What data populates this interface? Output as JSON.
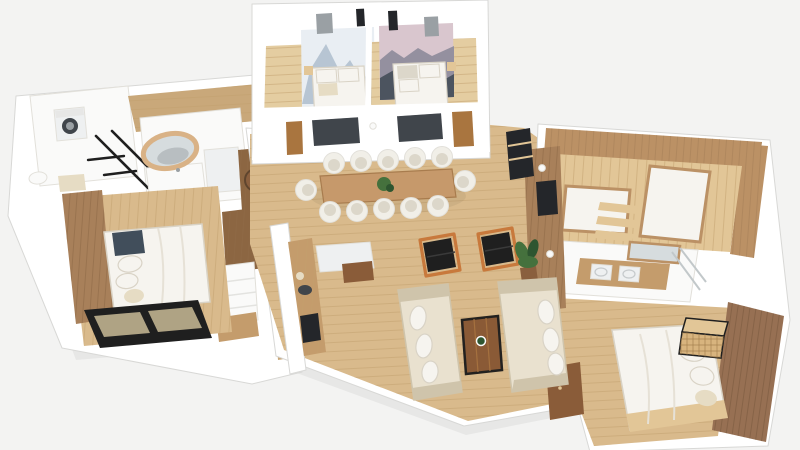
{
  "scene": {
    "type": "3d-floor-plan-render",
    "view": "isometric-top-down",
    "rooms": [
      {
        "name": "laundry",
        "furniture": [
          "washing-machine",
          "toilet",
          "bath-mat"
        ]
      },
      {
        "name": "bathroom-left",
        "furniture": [
          "round-gold-mirror",
          "vanity",
          "black-ladder-rack"
        ]
      },
      {
        "name": "entry-hallway",
        "furniture": [
          "coat-hooks"
        ]
      },
      {
        "name": "bedroom-left",
        "furniture": [
          "double-bed",
          "wood-accent-wall",
          "sliding-glass-door"
        ]
      },
      {
        "name": "closet-corridor",
        "furniture": [
          "wardrobe",
          "open-shelves",
          "bench",
          "woven-wall-decor"
        ]
      },
      {
        "name": "bedroom-top-left",
        "furniture": [
          "double-bed",
          "snow-mountain-mural",
          "wall-tv"
        ]
      },
      {
        "name": "bedroom-top-right",
        "furniture": [
          "double-bed",
          "gradient-mountain-mural",
          "wall-tv"
        ]
      },
      {
        "name": "kitchen",
        "furniture": [
          "island-marble-counter",
          "wood-counter",
          "sink",
          "cooktop"
        ]
      },
      {
        "name": "dining-area",
        "furniture": [
          "long-dining-table",
          "twelve-chairs",
          "centerpiece-plant"
        ]
      },
      {
        "name": "living-room",
        "furniture": [
          "sofa",
          "sofa",
          "coffee-table",
          "armchair",
          "armchair",
          "potted-plant",
          "media-wall-tv",
          "sideboard",
          "shelf-unit"
        ]
      },
      {
        "name": "sauna",
        "furniture": [
          "wood-plank-walls",
          "lounger-bench",
          "lounger-bench"
        ]
      },
      {
        "name": "bathroom-right",
        "furniture": [
          "double-sink-vanity",
          "mirror",
          "glass-shower"
        ]
      },
      {
        "name": "bedroom-bottom-right",
        "furniture": [
          "double-bed",
          "dark-plank-accent-wall",
          "rattan-cabinet"
        ]
      }
    ],
    "chair_count": 12
  },
  "palette": {
    "bg": "#f3f3f2",
    "wallWhite": "#ffffff",
    "wallShade": "#e7e7e6",
    "floorOak": "#d9ba8c",
    "floorOakLight": "#e4cda1",
    "floorHall": "#c9a87a",
    "plankLine": "#c2a06e",
    "accentOak": "#a8805a",
    "accentLine": "#8f6a48",
    "darkPlank": "#977053",
    "darkLine": "#7c5a3f",
    "saunaWood": "#bb9165",
    "saunaLight": "#e2c697",
    "saunaLine": "#a57f57",
    "tableWood": "#c6996b",
    "counterWood": "#c49c6c",
    "cabinetBrown": "#8c6642",
    "doorBrown": "#a9753f",
    "sideboard": "#8a5c39",
    "coffeeWood": "#8a5a36",
    "marble": "#eef0f1",
    "linen": "#f6f4ef",
    "linenShadow": "#d9d3c6",
    "sofa": "#e9e1cf",
    "sofaShadow": "#cfc4ab",
    "chair": "#f1efe8",
    "chairShadow": "#dcd7ca",
    "black": "#1f1f1f",
    "orange": "#c8793c",
    "tv": "#24262a",
    "windowDark": "#40454b",
    "glassTint": "#c9bb97",
    "glassLine": "#c2c8ca",
    "gold": "#d9b286",
    "mirror": "#d6dcde",
    "plant": "#45713d",
    "plantDark": "#2e5530",
    "pot": "#8a5f3e",
    "rattan": "#d8b47e",
    "rattanLine": "#a5804f",
    "slate": "#414e5b",
    "steel": "#9aa0a4",
    "beige": "#e6dcc4",
    "white": "#fafaf9",
    "muralSnowLight": "#e9eef3",
    "muralSnowMid": "#b7c5d3",
    "muralSnowDark": "#7e93a8",
    "muralTop": "#d9c6ce",
    "muralMid": "#94909f",
    "muralDark": "#4c545f"
  }
}
